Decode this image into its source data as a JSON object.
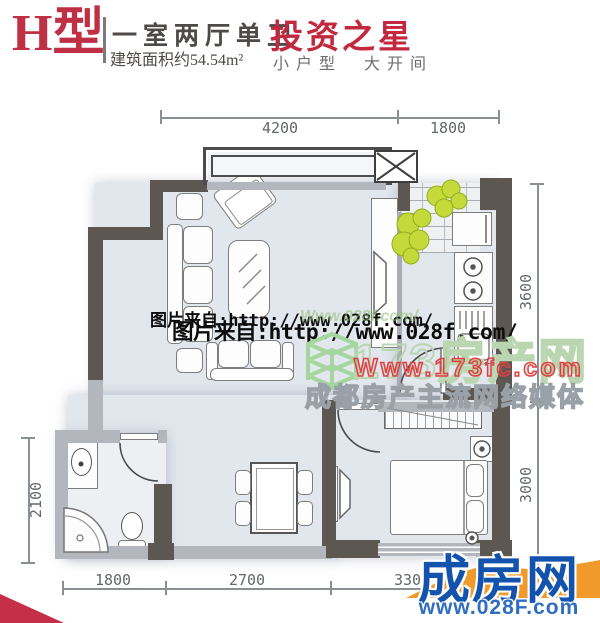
{
  "header": {
    "type_label": "H型",
    "layout": "一室两厅单卫",
    "area": "建筑面积约54.54m²",
    "slogan": "投资之星",
    "sub_left": "小户型",
    "sub_right": "大开间"
  },
  "dimensions": {
    "top": [
      "4200",
      "1800"
    ],
    "right": [
      "3600",
      "3000"
    ],
    "left": [
      "2100"
    ],
    "bottom": [
      "1800",
      "2700",
      "3300"
    ]
  },
  "watermarks": {
    "source": "图片来自:http://www.028f.com/",
    "green_echo": "Www.028f.com/",
    "brand": "173房产网",
    "brand_url": "Www.173fc.com",
    "tagline": "成都房产主流网络媒体"
  },
  "logo": {
    "name": "成房网",
    "url": "www.028F.com"
  },
  "colors": {
    "wall_dark": "#5d5751",
    "wall_light": "#b3b7bd",
    "floor": "#e2e6ed",
    "accent_red": "#c2293e",
    "logo_blue": "#1353ae",
    "logo_orange": "#f09a2c",
    "plant_green": "#c4da3b"
  }
}
